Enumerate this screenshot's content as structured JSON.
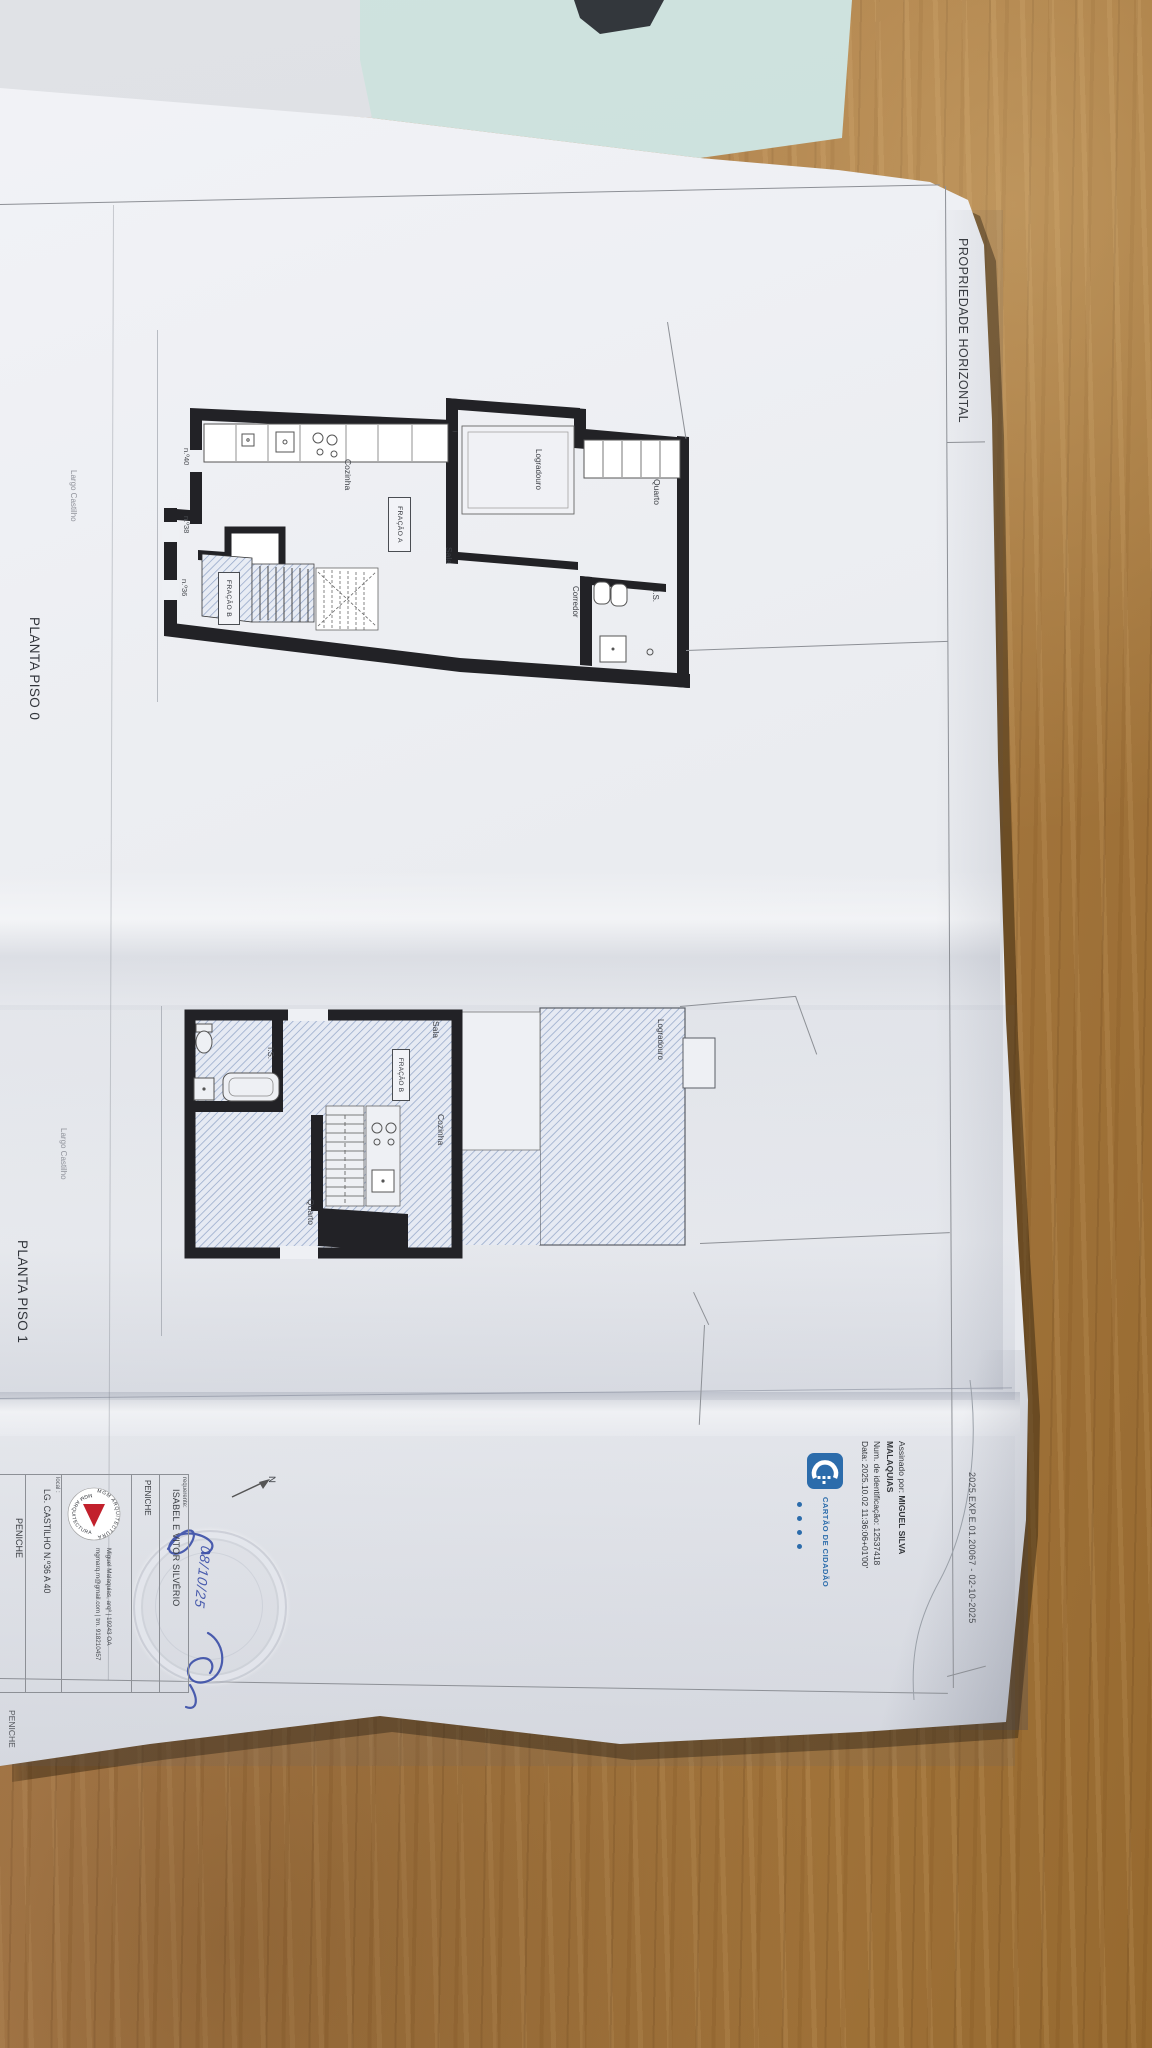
{
  "header": {
    "title": "PROPRIEDADE HORIZONTAL",
    "reference": "2025.EXP.E.01.20067 - 02-10-2025"
  },
  "piso0": {
    "title": "PLANTA PISO 0",
    "street": "Largo Castilho",
    "fracao_a": "FRAÇÃO A",
    "fracao_b": "FRAÇÃO B",
    "rooms": {
      "cozinha": "Cozinha",
      "sala": "Sala",
      "corredor": "Corredor",
      "is": "I.S.",
      "quarto": "Quarto",
      "logradouro": "Logradouro"
    },
    "numbers": {
      "n40": "n.º40",
      "n38": "n.º38",
      "n36": "n.º36"
    }
  },
  "piso1": {
    "title": "PLANTA PISO 1",
    "street": "Largo Castilho",
    "fracao_b": "FRAÇÃO B",
    "rooms": {
      "sala": "Sala",
      "cozinha": "Cozinha",
      "is": "I.S.",
      "quarto": "Quarto",
      "logradouro": "Logradouro"
    }
  },
  "signature": {
    "label": "Assinado por: ",
    "name1": "MIGUEL SILVA",
    "name2": "MALAQUIAS",
    "id_line": "Num. de identificação: 12537418",
    "date_line": "Data: 2025.10.02 11:36:06+01'00'"
  },
  "cc": {
    "text": "CARTÃO DE CIDADÃO"
  },
  "titleblock": {
    "requerente_label": "requerente:",
    "requerente": "ISABEL E VITOR SILVÉRIO",
    "city": "PENICHE",
    "arch_line1": "Miguel Malaquias, arqº | 19243 OA",
    "arch_line2": "mgmarq.m@gmail.com | tm. 918210457",
    "local_label": "local :",
    "address": "LG. CASTILHO N.º36 A 40",
    "local_city": "PENICHE",
    "bottom_city": "PENICHE",
    "logo_arc": "MGM ARQUITECTURA"
  },
  "north": {
    "label": "N"
  },
  "handwriting": {
    "date": "08/10/25"
  },
  "colors": {
    "paper": "#eceef2",
    "wood": "#a97c44",
    "wall": "#222226",
    "hatch_blue": "#8fa3c6",
    "cc_blue": "#2c6cab",
    "mgm_red": "#c2202c",
    "ink_blue": "#3a4ea8"
  }
}
